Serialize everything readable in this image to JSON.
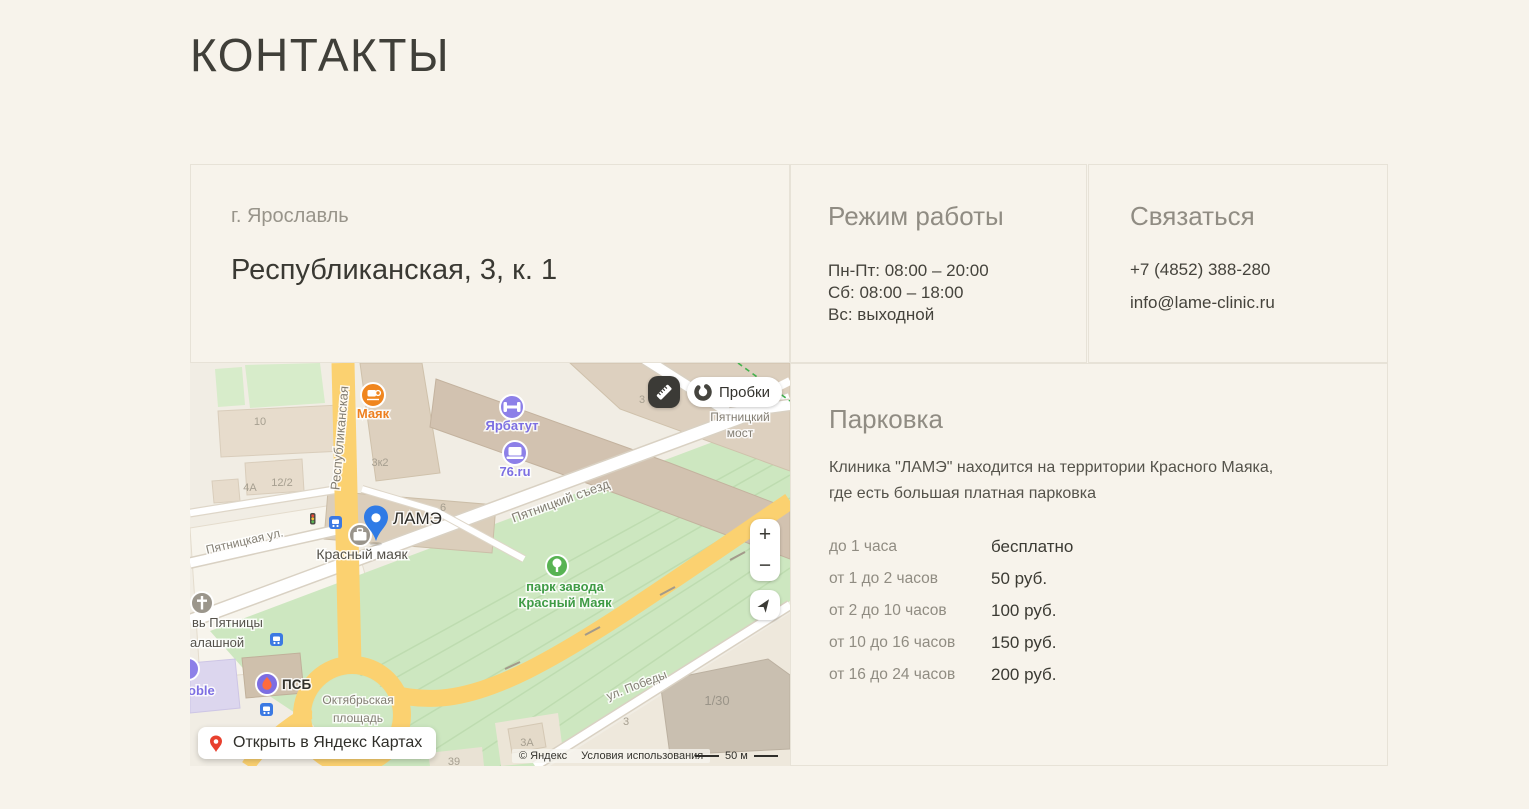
{
  "title": "КОНТАКТЫ",
  "address": {
    "city": "г. Ярославль",
    "street": "Республиканская, 3, к. 1"
  },
  "hours": {
    "heading": "Режим работы",
    "lines": [
      "Пн-Пт: 08:00 – 20:00",
      "Сб: 08:00 – 18:00",
      "Вс: выходной"
    ]
  },
  "contact": {
    "heading": "Связаться",
    "phone": "+7 (4852) 388-280",
    "email": "info@lame-clinic.ru"
  },
  "parking": {
    "heading": "Парковка",
    "description": "Клиника \"ЛАМЭ\" находится на территории Красного Маяка, где есть большая платная парковка",
    "rates": [
      {
        "duration": "до 1 часа",
        "price": "бесплатно"
      },
      {
        "duration": "от 1 до 2 часов",
        "price": "50 руб."
      },
      {
        "duration": "от 2 до 10 часов",
        "price": "100 руб."
      },
      {
        "duration": "от 10 до 16 часов",
        "price": "150 руб."
      },
      {
        "duration": "от 16 до 24 часов",
        "price": "200 руб."
      }
    ]
  },
  "map": {
    "traffic_button": "Пробки",
    "open_button": "Открыть в Яндекс Картах",
    "zoom_in": "+",
    "zoom_out": "−",
    "copyright": "© Яндекс",
    "terms": "Условия использования",
    "scale": "50 м",
    "pin_label": "ЛАМЭ",
    "labels": {
      "respublikanskaya": "Республиканская",
      "pyatnitskaya": "Пятницкая ул.",
      "pyatnitsky_sezd": "Пятницкий съезд",
      "pyatnitsky_most_line1": "Пятницкий",
      "pyatnitsky_most_line2": "мост",
      "pobedy": "ул. Победы",
      "oktyabrskaya_line1": "Октябрьская",
      "oktyabrskaya_line2": "площадь",
      "park_line1": "парк завода",
      "park_line2": "Красный Маяк",
      "krasny_mayak": "Красный маяк",
      "mayak": "Маяк",
      "yarbatut": "Ярбатут",
      "ru76": "76.ru",
      "psb": "ПСБ",
      "church_line1": "вь Пятницы",
      "church_line2": "алашной",
      "mobile_partial": "oble"
    },
    "building_numbers": [
      "10",
      "3к2",
      "12/2",
      "4А",
      "6",
      "3",
      "1/30",
      "3А",
      "39",
      "3"
    ],
    "colors": {
      "pin_blue": "#2f7be6",
      "poi_purple": "#8d80e8",
      "poi_orange": "#f0861f",
      "park_green": "#58b353",
      "road_yellow": "#fbd170"
    }
  }
}
